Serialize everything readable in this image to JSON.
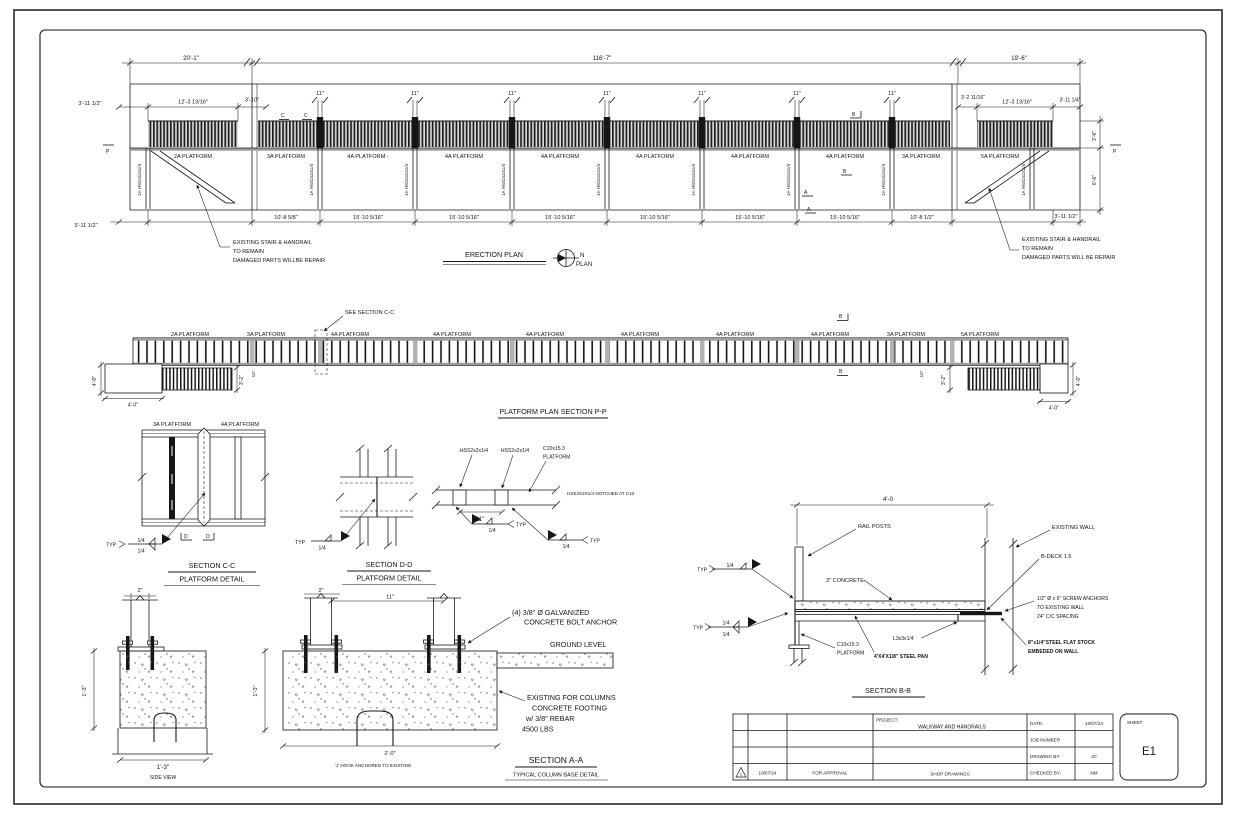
{
  "labels": {
    "p2a": "2A   PLATFORM",
    "p3a": "3A   PLATFORM",
    "p4a": "4A   PLATFORM",
    "p4ad": "4A   PLATFORM  -",
    "p5a": "5A   PLATFORM",
    "col": "1A   HSS2x2x1/4",
    "hss": "HSS2x2x1/4",
    "typ": "TYP",
    "q14": "1/4"
  },
  "erection": {
    "title": "ERECTION PLAN",
    "north_n": "N",
    "north_plan": "PLAN",
    "d20": "20'-1\"",
    "d116": "116'-7\"",
    "d19": "19'-6\"",
    "d3112": "3'-11 1/2\"",
    "d12313": "12'-3 13/16\"",
    "d310": "3'-10\"",
    "d3211": "3'-2 11/16\"",
    "d3114": "3'-11 1/4\"",
    "d11": "11\"",
    "d1085": "10'-8 5/8\"",
    "d15105": "15'-10 5/16\"",
    "d1081": "10'-8 1/2\"",
    "d36": "3'-6\"",
    "d66": "6'-6\"",
    "mP": "P",
    "mC": "C",
    "mB": "B",
    "mA": "A",
    "note1": "EXISTING STAIR & HANDRAIL",
    "note2": "TO REMAIN",
    "note3l": "DAMAGED PARTS WILLBE REPAIR",
    "note3r": "DAMAGED PARTS WILL BE REPAIR"
  },
  "plan": {
    "title": "PLATFORM PLAN SECTION P-P",
    "see_cc": "SEE SECTION C-C",
    "d40": "4'-0\"",
    "d32": "3'-2\"",
    "d10": "10\""
  },
  "section_cc": {
    "title": "SECTION C-C",
    "subtitle": "PLATFORM  DETAIL",
    "mD": "D"
  },
  "section_dd": {
    "title": "SECTION D-D",
    "subtitle": "PLATFORM  DETAIL"
  },
  "notch": {
    "c10": "C10x15.3",
    "platform": "PLATFORM",
    "note": "HSS2X2X1/4 NOTCHED AT C10"
  },
  "section_bb": {
    "title": "SECTION B-B",
    "d40": "4'-0",
    "rail_posts": "RAIL POSTS",
    "concrete": "3\" CONCRETE",
    "existing_wall": "EXISTING WALL",
    "bdeck": "B-DECK 1.5",
    "anch1": "1/2\" Ø x 6\" SCREW ANCHORS",
    "anch2": "TO EXISTING WALL",
    "anch3": "24\" C/C SPACING",
    "flat1": "8\"x1/4\"STEEL FLAT STOCK",
    "flat2": "EMBEDED ON WALL",
    "l3": "L3x3x1/4",
    "steelpan": "4'X4'X1/8\" STEEL PAN"
  },
  "footing": {
    "side_view": "SIDE VIEW",
    "d2": "2\"",
    "d13": "1'-3\"",
    "d20": "2'-0\"",
    "ground": "GROUND LEVEL",
    "ga1": "(4) 3/8\" Ø GALVANIZED",
    "ga2": "CONCRETE BOLT ANCHOR",
    "f1": "EXISTING FOR COLUMNS",
    "f2": "CONCRETE FOOTING",
    "f3": "w/ 3/8\" REBAR",
    "f4": "4500 LBS",
    "jhook": "'J' HOOK ANCHORED TO EXISTING",
    "title": "SECTION A-A",
    "subtitle": "TYPICAL COLUMN BASE DETAIL"
  },
  "titleblock": {
    "project_label": "PROJECT:",
    "project": "WALKWAY AND HANDRAILS",
    "date_label": "DATE:",
    "date": "10/07/24",
    "job_label": "JOB NUMBER",
    "drawn_label": "DRAWING BY:",
    "drawn": "JC",
    "checked_label": "CHECKED BY:",
    "checked": "NM",
    "sheet_label": "SHEET:",
    "sheet": "E1",
    "rev_no": "1",
    "rev_date": "10/07/24",
    "rev_desc": "FOR APPROVAL",
    "rev_type": "SHOP DRAWINGS"
  }
}
